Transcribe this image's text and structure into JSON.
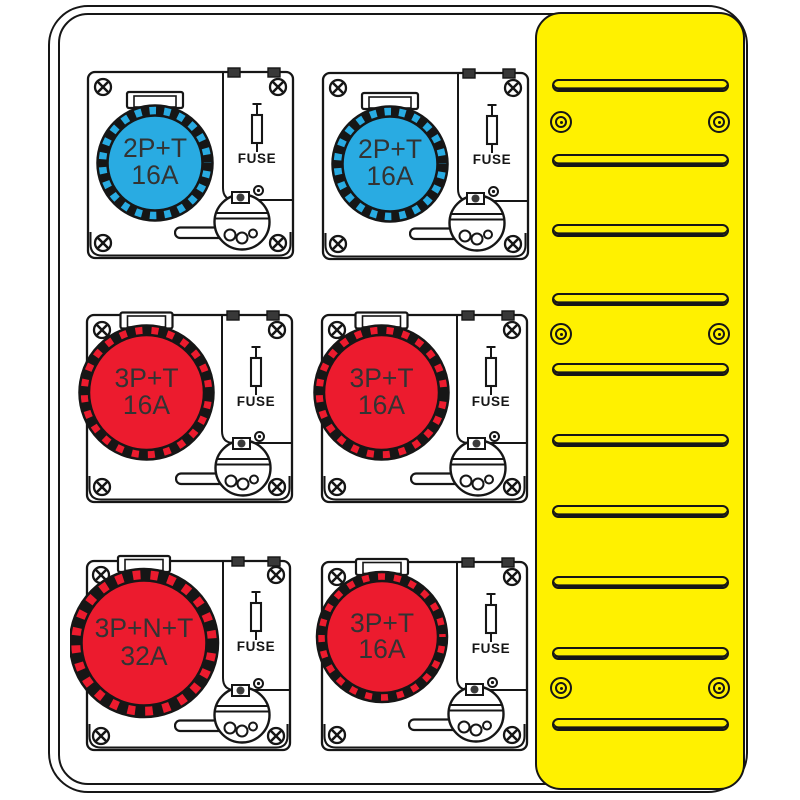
{
  "colors": {
    "socket_blue": "#29ABE2",
    "socket_red": "#EC1B2E",
    "panel_yellow": "#FFF100",
    "line": "#161616",
    "background": "#FFFFFF"
  },
  "units": [
    {
      "label_line1": "2P+T",
      "label_line2": "16A",
      "fuse_label": "FUSE",
      "color": "#29ABE2"
    },
    {
      "label_line1": "2P+T",
      "label_line2": "16A",
      "fuse_label": "FUSE",
      "color": "#29ABE2"
    },
    {
      "label_line1": "3P+T",
      "label_line2": "16A",
      "fuse_label": "FUSE",
      "color": "#EC1B2E"
    },
    {
      "label_line1": "3P+T",
      "label_line2": "16A",
      "fuse_label": "FUSE",
      "color": "#EC1B2E"
    },
    {
      "label_line1": "3P+N+T",
      "label_line2": "32A",
      "fuse_label": "FUSE",
      "color": "#EC1B2E"
    },
    {
      "label_line1": "3P+T",
      "label_line2": "16A",
      "fuse_label": "FUSE",
      "color": "#EC1B2E"
    }
  ],
  "vent_panel": {
    "slot_count": 10,
    "screw_count": 6,
    "color": "#FFF100"
  }
}
